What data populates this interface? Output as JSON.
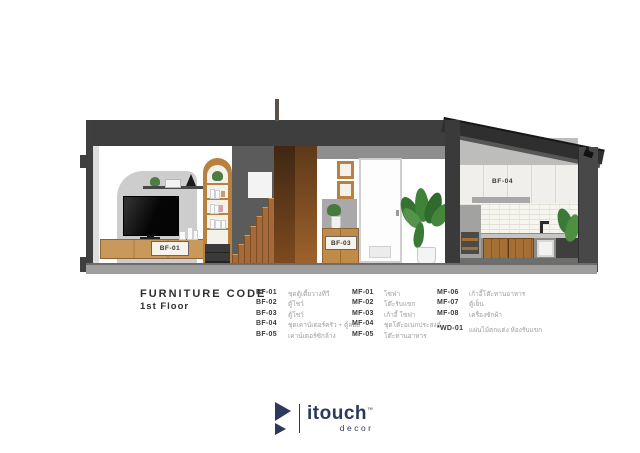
{
  "drawing": {
    "labels": {
      "bf01": "BF-01",
      "bf03": "BF-03",
      "bf04": "BF-04"
    }
  },
  "legend": {
    "title": "FURNITURE CODE",
    "subtitle": "1st Floor",
    "col1": [
      {
        "code": "BF-01",
        "desc": "ชุดตู้เตี้ยวางทีวี"
      },
      {
        "code": "BF-02",
        "desc": "ตู้โชว์"
      },
      {
        "code": "BF-03",
        "desc": "ตู้โชว์"
      },
      {
        "code": "BF-04",
        "desc": "ชุดเคาน์เตอร์ครัว + ตู้ลอย"
      },
      {
        "code": "BF-05",
        "desc": "เคาน์เตอร์ซักล้าง"
      }
    ],
    "col2": [
      {
        "code": "MF-01",
        "desc": "โซฟา"
      },
      {
        "code": "MF-02",
        "desc": "โต๊ะรับแขก"
      },
      {
        "code": "MF-03",
        "desc": "เก้าอี้ โซฟา"
      },
      {
        "code": "MF-04",
        "desc": "ชุดโต๊ะอเนกประสงค์"
      },
      {
        "code": "MF-05",
        "desc": "โต๊ะทานอาหาร"
      }
    ],
    "col3": [
      {
        "code": "MF-06",
        "desc": "เก้าอี้โต๊ะทานอาหาร"
      },
      {
        "code": "MF-07",
        "desc": "ตู้เย็น"
      },
      {
        "code": "MF-08",
        "desc": "เครื่องซักผ้า"
      }
    ],
    "note": {
      "code": "*WD-01",
      "desc": "แผ่นไม้ตกแต่ง ห้องรับแขก"
    }
  },
  "logo": {
    "wordmark": "itouch",
    "tm": "™",
    "tagline": "decor",
    "brand_color": "#2b3a5c"
  }
}
